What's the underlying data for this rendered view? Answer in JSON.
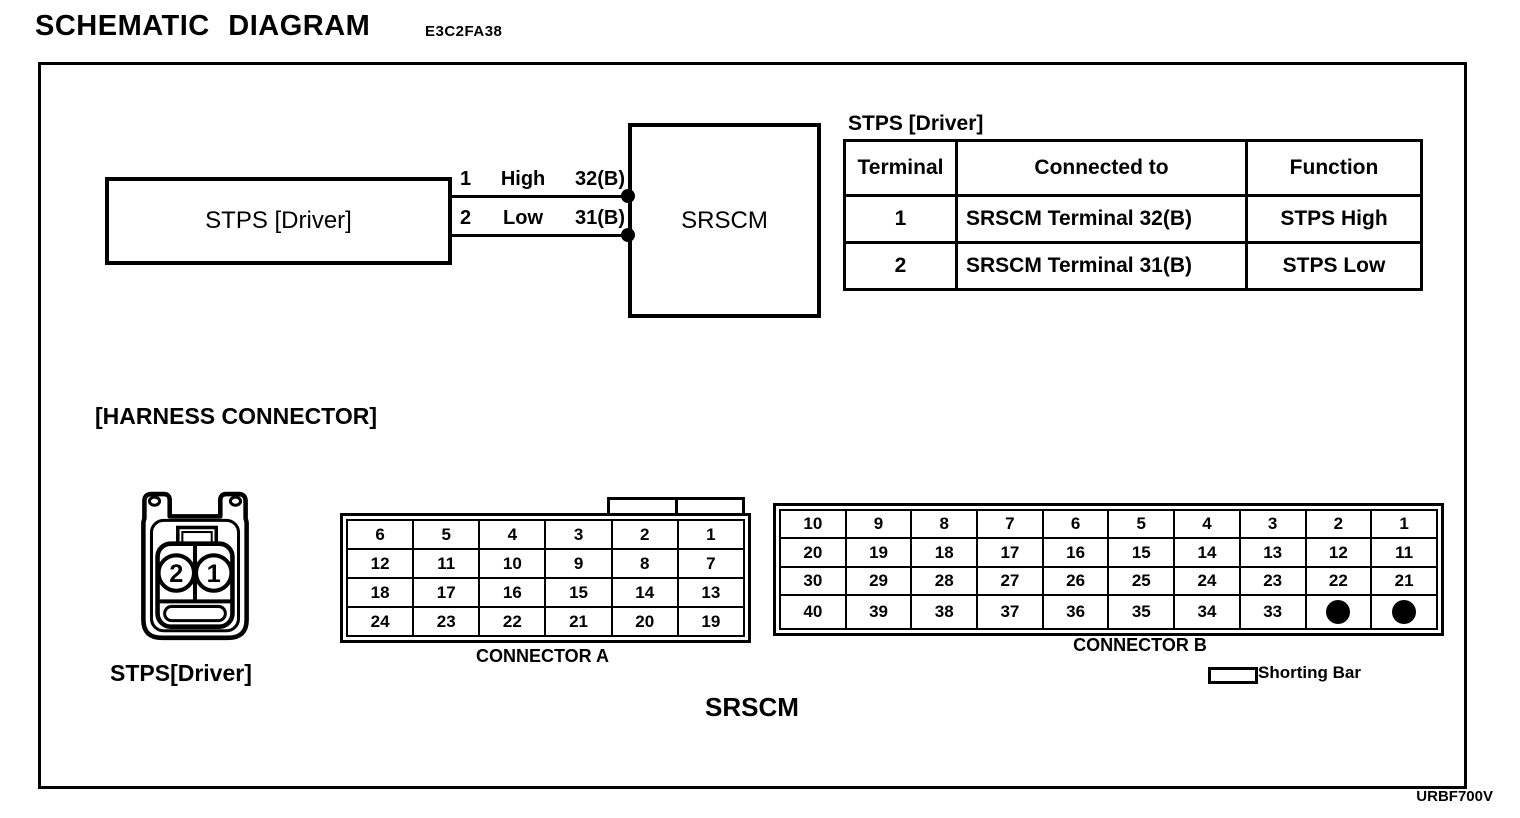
{
  "page": {
    "title": "SCHEMATIC DIAGRAM",
    "code": "E3C2FA38",
    "footer_code": "URBF700V"
  },
  "schematic": {
    "stps_box": "STPS [Driver]",
    "srscm_box": "SRSCM",
    "wires": [
      {
        "terminal": "1",
        "signal": "High",
        "pin": "32(B)"
      },
      {
        "terminal": "2",
        "signal": "Low",
        "pin": "31(B)"
      }
    ]
  },
  "terminal_table": {
    "title": "STPS [Driver]",
    "headers": [
      "Terminal",
      "Connected to",
      "Function"
    ],
    "rows": [
      [
        "1",
        "SRSCM Terminal 32(B)",
        "STPS High"
      ],
      [
        "2",
        "SRSCM Terminal 31(B)",
        "STPS Low"
      ]
    ]
  },
  "harness": {
    "section_label": "[HARNESS CONNECTOR]",
    "stps_connector": {
      "label": "STPS[Driver]",
      "pins": [
        "2",
        "1"
      ]
    },
    "connector_a": {
      "label": "CONNECTOR A",
      "rows": [
        [
          "6",
          "5",
          "4",
          "3",
          "2",
          "1"
        ],
        [
          "12",
          "11",
          "10",
          "9",
          "8",
          "7"
        ],
        [
          "18",
          "17",
          "16",
          "15",
          "14",
          "13"
        ],
        [
          "24",
          "23",
          "22",
          "21",
          "20",
          "19"
        ]
      ]
    },
    "connector_b": {
      "label": "CONNECTOR B",
      "rows": [
        [
          "10",
          "9",
          "8",
          "7",
          "6",
          "5",
          "4",
          "3",
          "2",
          "1"
        ],
        [
          "20",
          "19",
          "18",
          "17",
          "16",
          "15",
          "14",
          "13",
          "12",
          "11"
        ],
        [
          "30",
          "29",
          "28",
          "27",
          "26",
          "25",
          "24",
          "23",
          "22",
          "21"
        ],
        [
          "40",
          "39",
          "38",
          "37",
          "36",
          "35",
          "34",
          "33",
          "●",
          "●"
        ]
      ]
    },
    "srscm_label": "SRSCM",
    "legend_shorting_bar": "Shorting Bar"
  },
  "colors": {
    "ink": "#000000",
    "paper": "#ffffff"
  }
}
